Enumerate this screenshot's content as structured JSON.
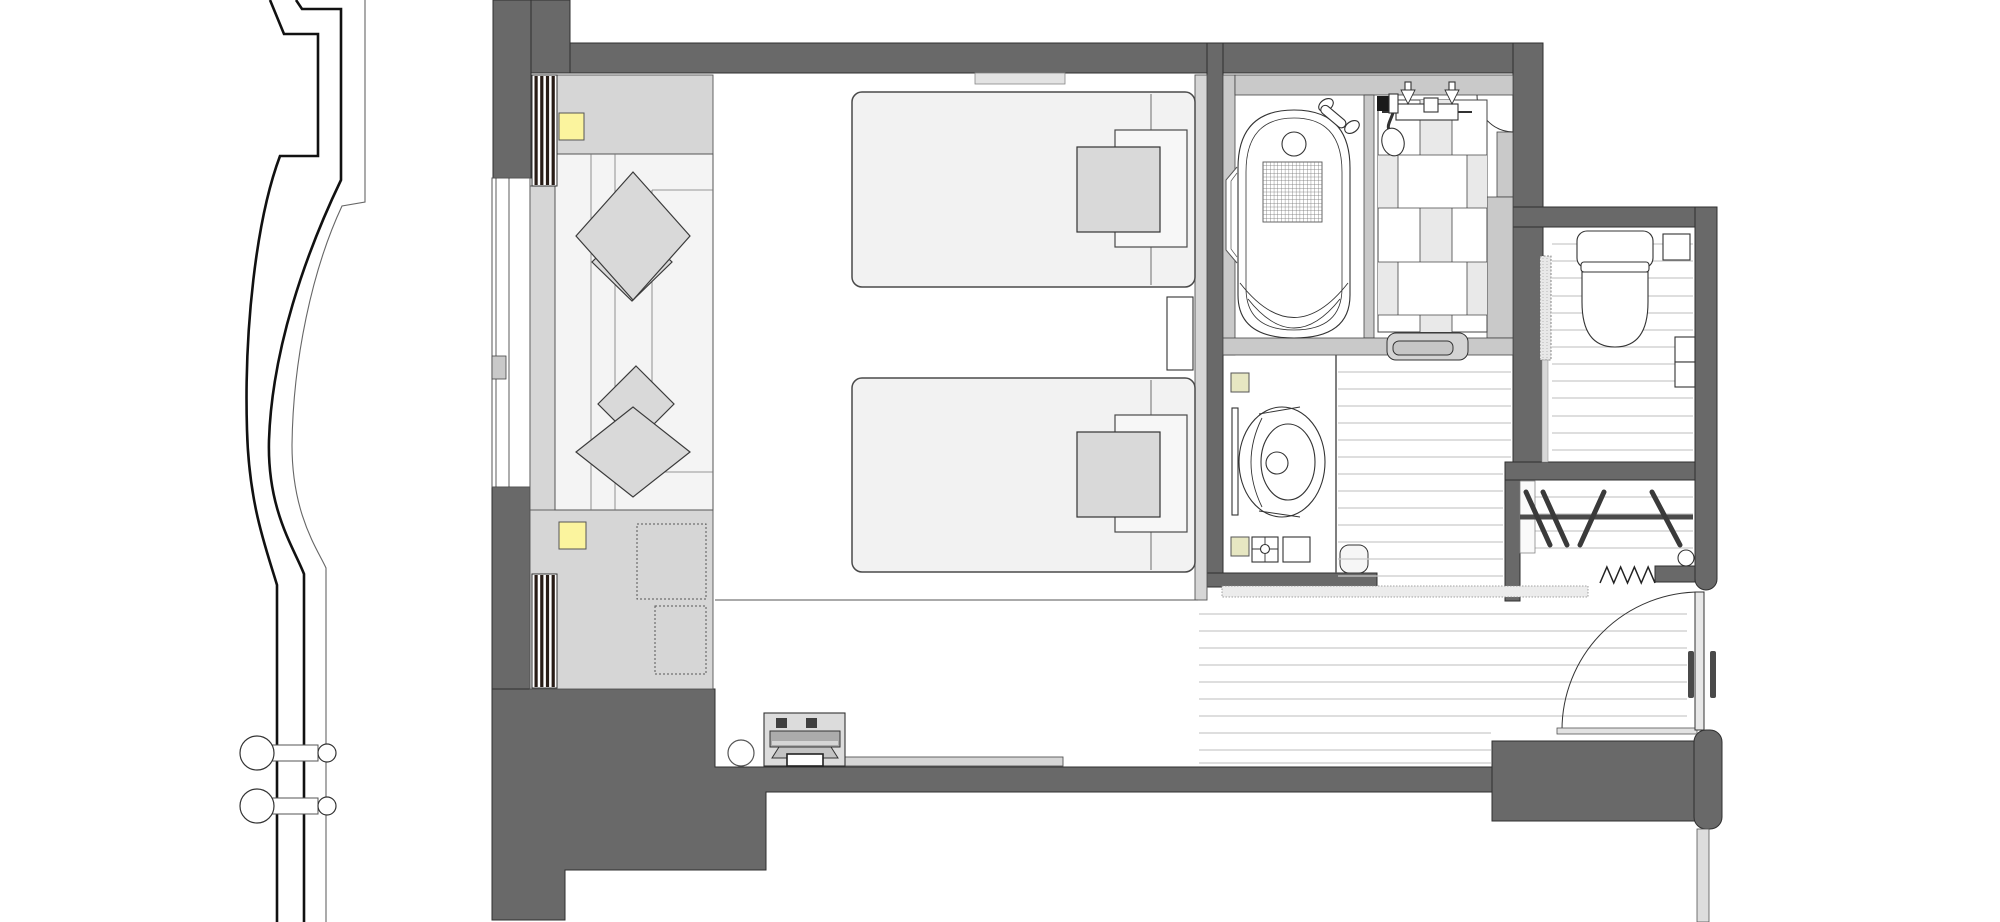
{
  "scene": {
    "type": "architectural-floor-plan",
    "subject": "hotel-twin-guestroom-plan",
    "visible_text": [],
    "rooms": [
      "bedroom",
      "sofa-corner",
      "bathroom",
      "shower-room",
      "vanity",
      "toilet-room",
      "closet",
      "entry-hall"
    ],
    "fixtures": [
      "twin-bed-1",
      "twin-bed-2",
      "nightstand",
      "sofa-with-cushions",
      "bathtub",
      "hand-shower-mixer",
      "vessel-sink",
      "toilet",
      "clothes-rod-with-hangers",
      "entry-door",
      "sliding-door",
      "luggage-rack",
      "stool",
      "downlights"
    ]
  },
  "colors": {
    "wall_dark": "#696969",
    "wall_outline": "#2f2f2f",
    "wall_light": "#c9c9c9",
    "panel": "#d6d6d6",
    "panel_stroke": "#555555",
    "bed": "#f2f2f2",
    "bed_stroke": "#4a4a4a",
    "pillow": "#d9d9d9",
    "pillow_stroke": "#3a3a3a",
    "sofa": "#f4f4f4",
    "yellow_bright": "#fbf49e",
    "yellow_soft": "#e7e7c2",
    "plank": "#c9c9c9",
    "tile": "#e9e9e9",
    "mullion": "#281c16",
    "line": "#333333",
    "white": "#ffffff"
  },
  "patterns": {
    "plank_regions": [
      {
        "target": "planks-hallway",
        "x1": 1338,
        "x2": 1511,
        "ys": [
          372,
          389,
          406,
          423,
          440,
          457
        ]
      },
      {
        "target": "planks-hallway",
        "x1": 1338,
        "x2": 1503,
        "ys": [
          474,
          491,
          508,
          525,
          542,
          559,
          576
        ]
      },
      {
        "target": "planks-toilet",
        "x1": 1552,
        "x2": 1693,
        "ys": [
          244,
          261,
          278,
          296,
          313,
          330,
          347,
          364,
          381,
          398,
          416,
          433,
          450
        ]
      },
      {
        "target": "planks-closet",
        "x1": 1521,
        "x2": 1693,
        "ys": [
          497,
          514,
          531,
          548
        ]
      },
      {
        "target": "planks-entry",
        "x1": 1199,
        "x2": 1687,
        "ys": [
          614,
          631,
          648,
          665,
          682,
          699,
          716
        ]
      },
      {
        "target": "planks-entry",
        "x1": 1199,
        "x2": 1491,
        "ys": [
          733,
          750,
          763
        ]
      }
    ],
    "hangers": [
      [
        1526,
        492,
        1550,
        545
      ],
      [
        1543,
        492,
        1567,
        545
      ],
      [
        1604,
        492,
        1580,
        545
      ],
      [
        1652,
        492,
        1680,
        545
      ]
    ],
    "zigzag": {
      "x1": 1600,
      "x2": 1655,
      "y_low": 583,
      "y_high": 567,
      "teeth": 8
    },
    "mullion_stripes": [
      {
        "x": 532,
        "y": 75,
        "w": 25,
        "h": 111
      },
      {
        "x": 532,
        "y": 574,
        "w": 25,
        "h": 114
      }
    ],
    "mat_grid": {
      "x": 1263,
      "y": 162,
      "w": 59,
      "h": 60,
      "nx": 16,
      "ny": 16
    },
    "facade_fins": [
      {
        "cy": 753
      },
      {
        "cy": 806
      }
    ]
  }
}
